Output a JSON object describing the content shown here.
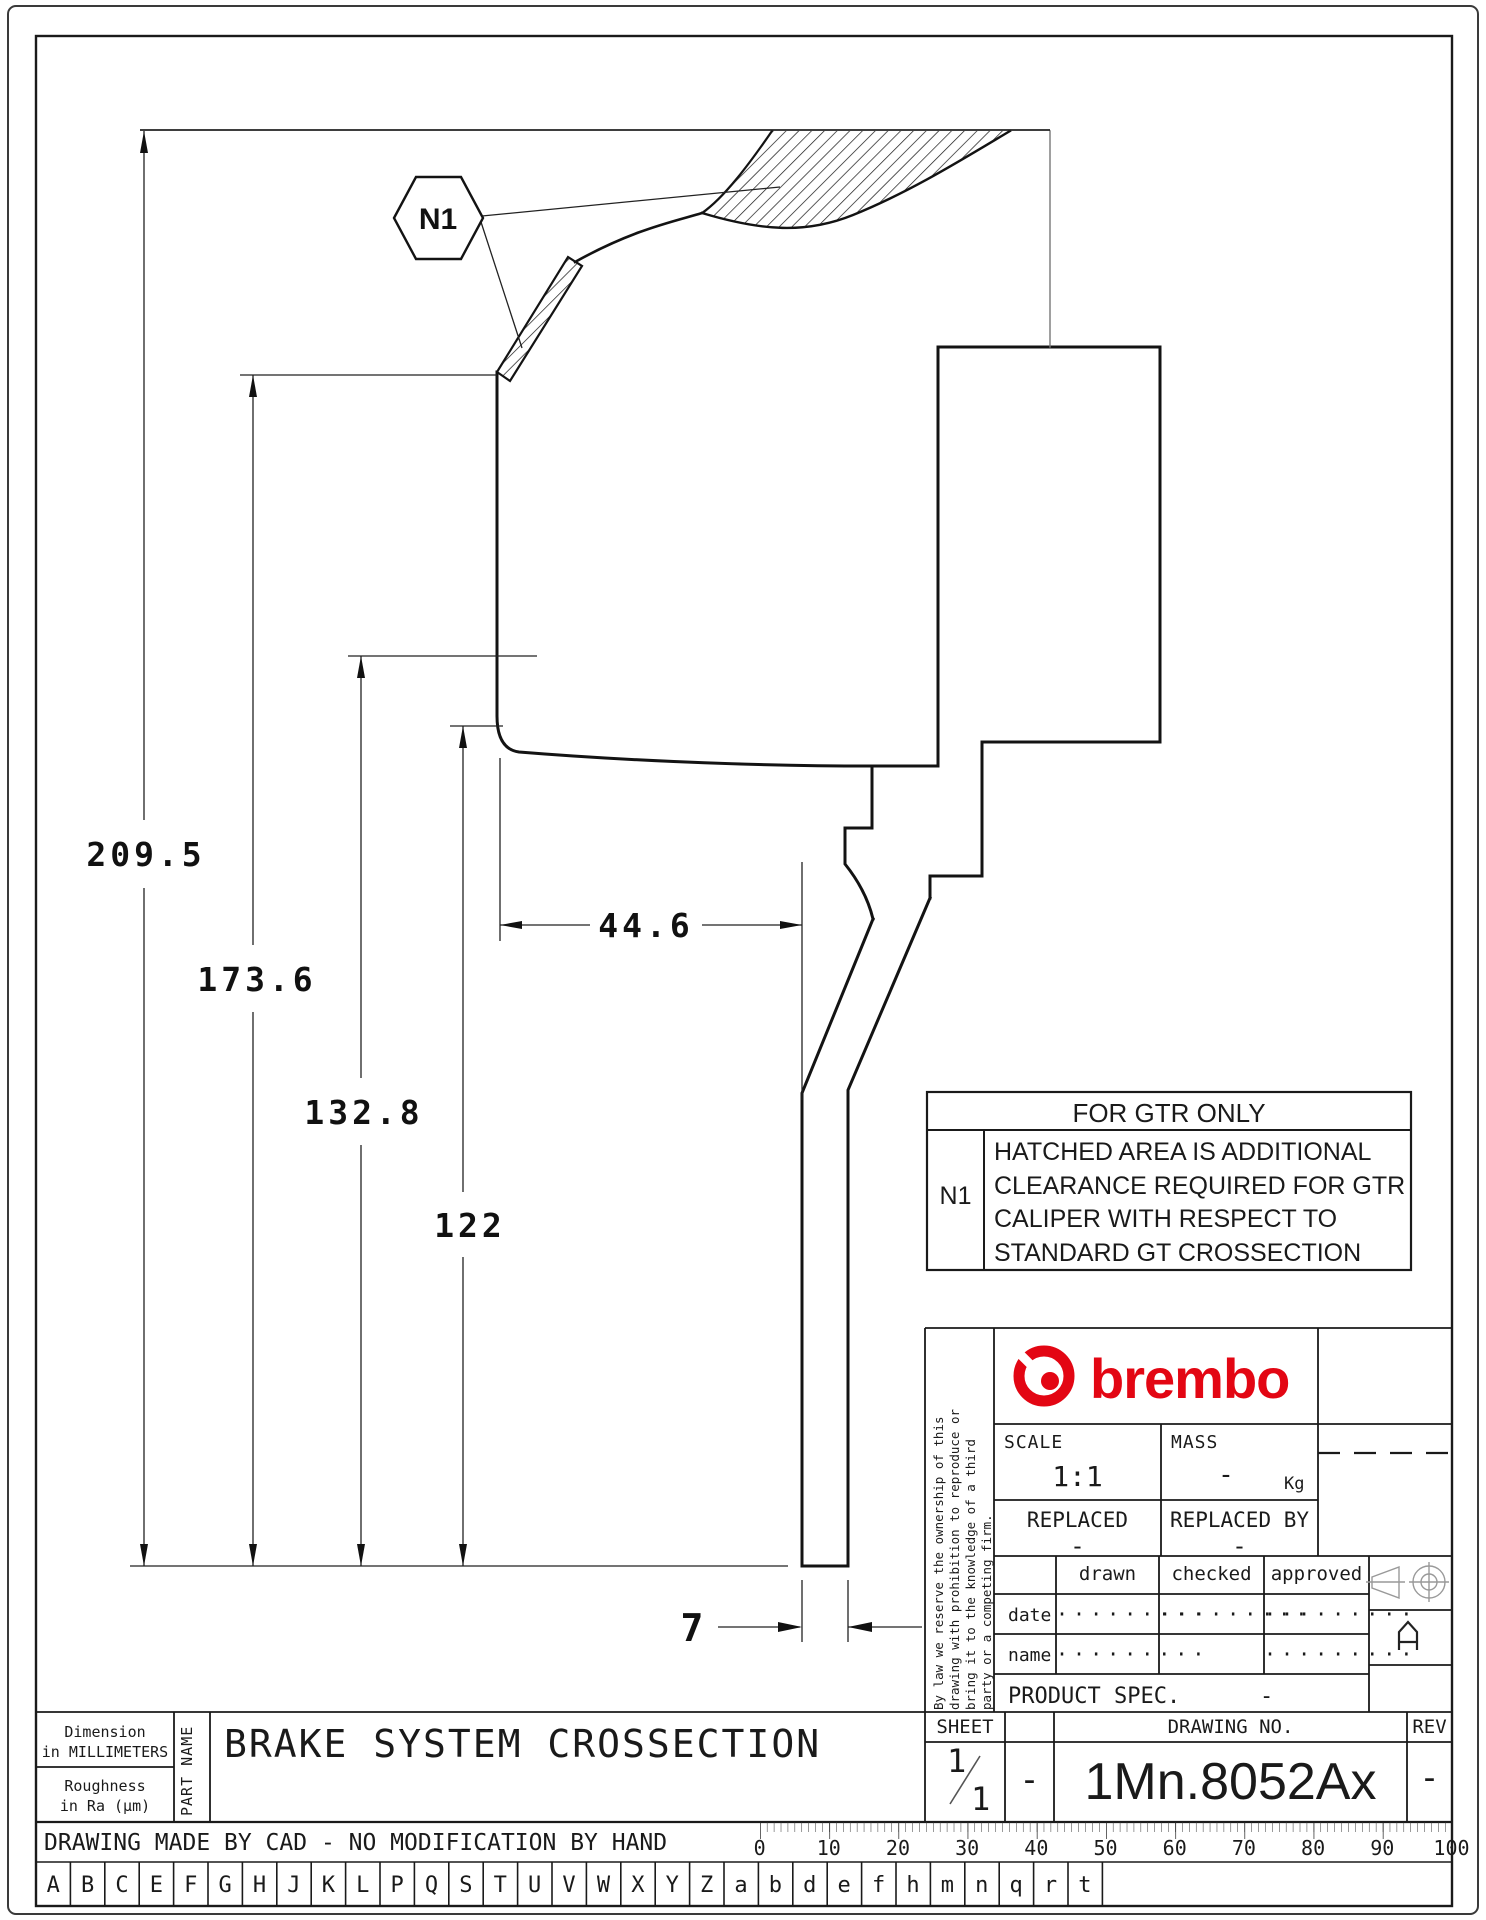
{
  "dimensions": {
    "total_height": "209.5",
    "hat_height": "173.6",
    "band_height": "132.8",
    "inner_height": "122",
    "width_offset": "44.6",
    "leg_thickness": "7"
  },
  "callout": {
    "label": "N1"
  },
  "gtr_note": {
    "title": "FOR GTR ONLY",
    "ref": "N1",
    "lines": [
      "HATCHED AREA IS ADDITIONAL",
      "CLEARANCE REQUIRED FOR GTR",
      "CALIPER WITH RESPECT TO",
      "STANDARD GT CROSSECTION"
    ]
  },
  "title_block": {
    "brand": "brembo",
    "scale_label": "SCALE",
    "scale_value": "1:1",
    "mass_label": "MASS",
    "mass_value": "-",
    "mass_unit": "Kg",
    "replaced_label": "REPLACED",
    "replaced_value": "-",
    "replaced_by_label": "REPLACED BY",
    "replaced_by_value": "-",
    "sign_headers": [
      "drawn",
      "checked",
      "approved"
    ],
    "date_label": "date",
    "name_label": "name",
    "date_dots": [
      "·········",
      "·········",
      "·········"
    ],
    "name_dots": [
      "·········",
      "",
      "·········"
    ],
    "product_spec_label": "PRODUCT SPEC.",
    "product_spec_value": "-",
    "sheet_label": "SHEET",
    "drawing_no_label": "DRAWING NO.",
    "rev_label": "REV",
    "sheet_numerator": "1",
    "sheet_denominator": "1",
    "sheet_dash": "-",
    "drawing_no": "1Mn.8052Ax",
    "rev_value": "-",
    "legal_lines": [
      "By law we reserve the ownership of this",
      "drawing with prohibition to reproduce or",
      "bring it to the knowledge of a third",
      "party or a competing firm."
    ]
  },
  "part_info": {
    "dimension_note_line1": "Dimension",
    "dimension_note_line2": "in MILLIMETERS",
    "roughness_line1": "Roughness",
    "roughness_line2": "in Ra (μm)",
    "part_name_label": "PART NAME",
    "part_name": "BRAKE SYSTEM CROSSECTION"
  },
  "footer": {
    "cad_note": "DRAWING MADE BY CAD - NO MODIFICATION BY HAND",
    "ruler_labels": [
      "0",
      "10",
      "20",
      "30",
      "40",
      "50",
      "60",
      "70",
      "80",
      "90",
      "100"
    ],
    "letters": [
      "A",
      "B",
      "C",
      "E",
      "F",
      "G",
      "H",
      "J",
      "K",
      "L",
      "P",
      "Q",
      "S",
      "T",
      "U",
      "V",
      "W",
      "X",
      "Y",
      "Z",
      "a",
      "b",
      "d",
      "e",
      "f",
      "h",
      "m",
      "n",
      "q",
      "r",
      "t"
    ]
  },
  "colors": {
    "brand_red": "#e30613",
    "line": "#161616"
  }
}
